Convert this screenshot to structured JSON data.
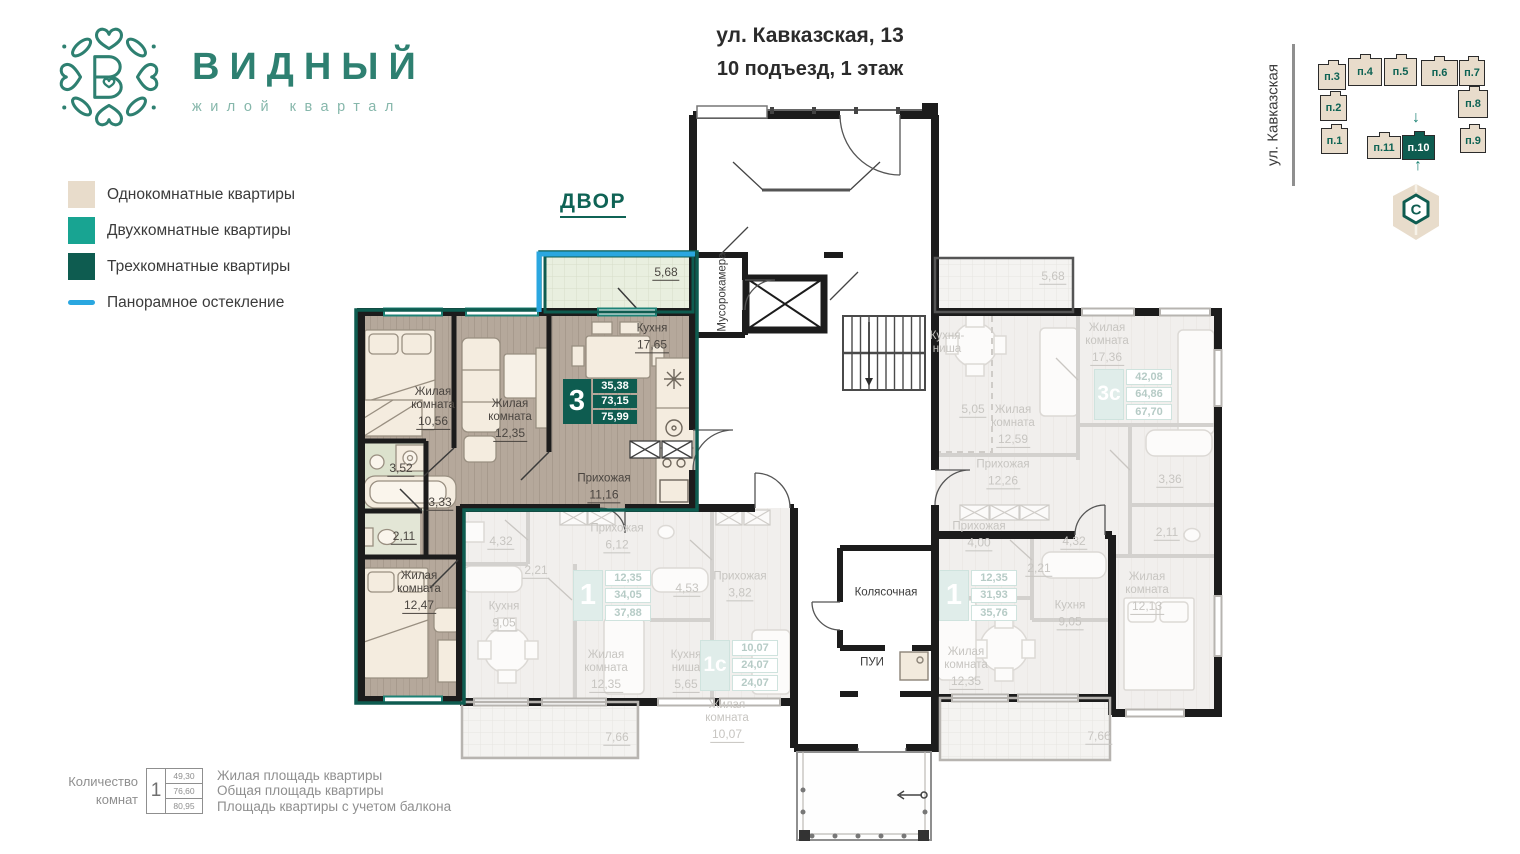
{
  "brand": {
    "name": "ВИДНЫЙ",
    "tagline": "жилой квартал"
  },
  "header": {
    "address_line1": "ул. Кавказская, 13",
    "address_line2": "10 подъезд, 1 этаж"
  },
  "legend": {
    "items": [
      {
        "label": "Однокомнатные квартиры",
        "color": "#e8dccb"
      },
      {
        "label": "Двухкомнатные квартиры",
        "color": "#18a492"
      },
      {
        "label": "Трехкомнатные квартиры",
        "color": "#0e5c50"
      },
      {
        "label": "Панорамное остекление",
        "color": "#2aa7e0"
      }
    ]
  },
  "minimap": {
    "street": "ул. Кавказская",
    "compass_letter": "C",
    "blocks": [
      {
        "label": "п.3",
        "x": 1318,
        "y": 64,
        "w": 28,
        "h": 26,
        "active": false
      },
      {
        "label": "п.4",
        "x": 1348,
        "y": 58,
        "w": 34,
        "h": 28,
        "active": false
      },
      {
        "label": "п.5",
        "x": 1384,
        "y": 58,
        "w": 33,
        "h": 28,
        "active": false
      },
      {
        "label": "п.6",
        "x": 1421,
        "y": 60,
        "w": 37,
        "h": 26,
        "active": false
      },
      {
        "label": "п.7",
        "x": 1459,
        "y": 60,
        "w": 26,
        "h": 26,
        "active": false
      },
      {
        "label": "п.2",
        "x": 1320,
        "y": 95,
        "w": 27,
        "h": 26,
        "active": false
      },
      {
        "label": "п.8",
        "x": 1458,
        "y": 90,
        "w": 30,
        "h": 28,
        "active": false
      },
      {
        "label": "п.1",
        "x": 1321,
        "y": 128,
        "w": 27,
        "h": 26,
        "active": false
      },
      {
        "label": "п.9",
        "x": 1460,
        "y": 128,
        "w": 26,
        "h": 25,
        "active": false
      },
      {
        "label": "п.11",
        "x": 1367,
        "y": 136,
        "w": 34,
        "h": 23,
        "active": false
      },
      {
        "label": "п.10",
        "x": 1402,
        "y": 135,
        "w": 33,
        "h": 25,
        "active": true
      }
    ]
  },
  "plan": {
    "courtyard_label": "ДВОР",
    "room_labels": [
      {
        "name": "Жилая\nкомната",
        "area": "10,56",
        "x": 433,
        "y": 408
      },
      {
        "name": "Жилая\nкомната",
        "area": "12,35",
        "x": 510,
        "y": 420
      },
      {
        "name": "Кухня",
        "area": "17,65",
        "x": 652,
        "y": 338
      },
      {
        "name": "Прихожая",
        "area": "11,16",
        "x": 604,
        "y": 488
      },
      {
        "area": "3,52",
        "x": 401,
        "y": 468
      },
      {
        "area": "3,33",
        "x": 440,
        "y": 502
      },
      {
        "area": "2,11",
        "x": 404,
        "y": 536
      },
      {
        "name": "Жилая\nкомната",
        "area": "12,47",
        "x": 419,
        "y": 592
      },
      {
        "area": "5,68",
        "x": 666,
        "y": 272
      },
      {
        "name": "Прихожая",
        "area": "6,12",
        "x": 617,
        "y": 538,
        "dim": true
      },
      {
        "area": "4,32",
        "x": 501,
        "y": 541,
        "dim": true
      },
      {
        "area": "2,21",
        "x": 536,
        "y": 570,
        "dim": true
      },
      {
        "name": "Кухня",
        "area": "9,05",
        "x": 504,
        "y": 616,
        "dim": true
      },
      {
        "name": "Жилая\nкомната",
        "area": "12,35",
        "x": 606,
        "y": 671,
        "dim": true
      },
      {
        "area": "7,66",
        "x": 617,
        "y": 737,
        "dim": true
      },
      {
        "area": "4,53",
        "x": 687,
        "y": 588,
        "dim": true
      },
      {
        "name": "Прихожая",
        "area": "3,82",
        "x": 740,
        "y": 586,
        "dim": true
      },
      {
        "name": "Кухня\nниша",
        "area": "5,65",
        "x": 686,
        "y": 671,
        "dim": true
      },
      {
        "name": "Жилая\nкомната",
        "area": "10,07",
        "x": 727,
        "y": 721,
        "dim": true
      },
      {
        "name": "Прихожая",
        "area": "4,00",
        "x": 979,
        "y": 536,
        "dim": true
      },
      {
        "area": "4,32",
        "x": 1074,
        "y": 541,
        "dim": true
      },
      {
        "area": "2,21",
        "x": 1039,
        "y": 568,
        "dim": true
      },
      {
        "name": "Кухня",
        "area": "9,05",
        "x": 1070,
        "y": 615,
        "dim": true
      },
      {
        "name": "Жилая\nкомната",
        "area": "12,35",
        "x": 966,
        "y": 668,
        "dim": true
      },
      {
        "area": "7,66",
        "x": 1099,
        "y": 736,
        "dim": true
      },
      {
        "name": "Кухня-\nниша",
        "x": 947,
        "y": 343,
        "dim": true
      },
      {
        "area": "5,05",
        "x": 973,
        "y": 409,
        "dim": true
      },
      {
        "name": "Жилая\nкомната",
        "area": "17,36",
        "x": 1107,
        "y": 344,
        "dim": true
      },
      {
        "name": "Жилая\nкомната",
        "area": "12,59",
        "x": 1013,
        "y": 426,
        "dim": true
      },
      {
        "name": "Прихожая",
        "area": "12,26",
        "x": 1003,
        "y": 474,
        "dim": true
      },
      {
        "area": "3,36",
        "x": 1170,
        "y": 479,
        "dim": true
      },
      {
        "area": "2,11",
        "x": 1167,
        "y": 532,
        "dim": true
      },
      {
        "name": "Жилая\nкомната",
        "area": "12,13",
        "x": 1147,
        "y": 593,
        "dim": true
      },
      {
        "area": "5,68",
        "x": 1053,
        "y": 276,
        "dim": true
      },
      {
        "name": "Мусорокамера",
        "x": 723,
        "y": 292,
        "vertical": true,
        "common": true
      },
      {
        "name": "Колясочная",
        "x": 886,
        "y": 593,
        "common": true
      },
      {
        "name": "ПУИ",
        "x": 872,
        "y": 663,
        "common": true
      }
    ],
    "badges": [
      {
        "number": "3",
        "values": [
          "35,38",
          "73,15",
          "75,99"
        ],
        "x": 563,
        "y": 379,
        "active": true
      },
      {
        "number": "1",
        "values": [
          "12,35",
          "34,05",
          "37,88"
        ],
        "x": 573,
        "y": 570,
        "active": false
      },
      {
        "number": "1с",
        "values": [
          "10,07",
          "24,07",
          "24,07"
        ],
        "x": 700,
        "y": 640,
        "active": false
      },
      {
        "number": "1",
        "values": [
          "12,35",
          "31,93",
          "35,76"
        ],
        "x": 939,
        "y": 570,
        "active": false
      },
      {
        "number": "3с",
        "values": [
          "42,08",
          "64,86",
          "67,70"
        ],
        "x": 1094,
        "y": 369,
        "active": false
      }
    ]
  },
  "footer_legend": {
    "count_label_line1": "Количество",
    "count_label_line2": "комнат",
    "sample_number": "1",
    "sample_values": [
      "49,30",
      "76,60",
      "80,95"
    ],
    "lines": [
      "Жилая площадь квартиры",
      "Общая площадь квартиры",
      "Площадь квартиры с учетом балкона"
    ]
  }
}
